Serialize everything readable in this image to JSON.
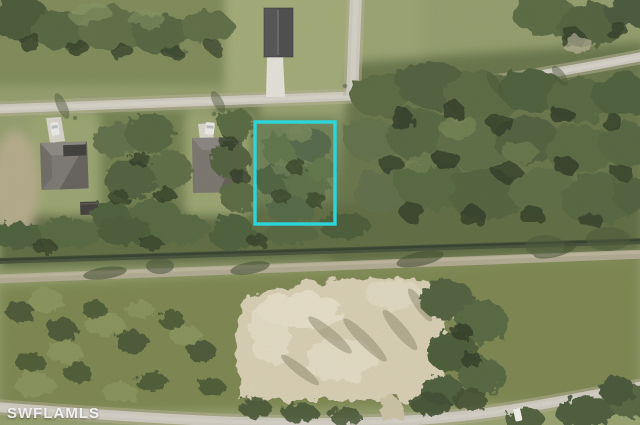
{
  "photo": {
    "kind": "aerial-satellite-photo",
    "watermark": {
      "text": "SWFLAMLS",
      "color": "rgba(255,255,255,0.85)"
    }
  },
  "lot_highlight": {
    "color": "#2BD6DA",
    "x": "255",
    "y": "122",
    "width": "80",
    "height": "102"
  },
  "palette": {
    "grass": "#939d6c",
    "lawn": "#a2aa77",
    "scrub": "#7f8a59",
    "forest": "#57673f",
    "tree_shadow": "#2e3a24",
    "road": "#cdc9be",
    "road_shoulder": "#b7b098",
    "canal_ditch": "#46523a",
    "dirt_track": "#b2ab92",
    "sand": "#d7ceb2",
    "roof_gray": "#7b7771",
    "roof_dark": "#4c4c4c",
    "driveway": "#dcd9cf"
  }
}
